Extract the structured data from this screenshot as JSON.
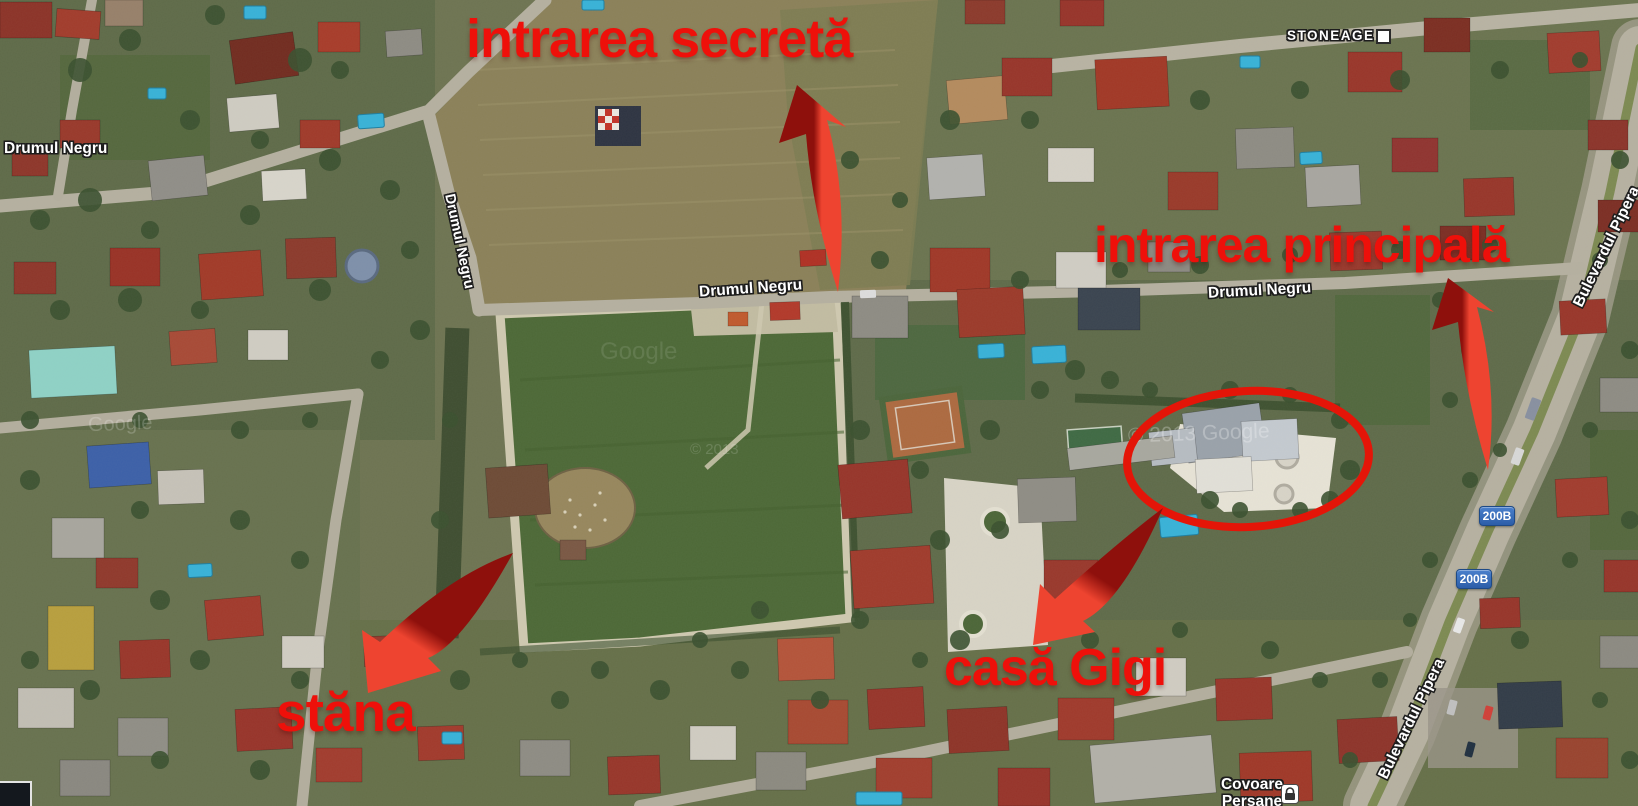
{
  "map": {
    "street_labels": {
      "drumul_negru": "Drumul Negru",
      "bulevardul_pipera": "Bulevardul Pipera",
      "stoneage": "STONEAGE"
    },
    "road_badge": {
      "route": "200B"
    },
    "poi": {
      "covoare_line1": "Covoare",
      "covoare_line2": "Persane"
    },
    "watermarks": {
      "google": "Google",
      "copyright_full": "© 2013 Google",
      "copyright_short": "© 2013"
    }
  },
  "annotations": {
    "secret_entrance": "intrarea secretă",
    "main_entrance": "intrarea principală",
    "gigi_house": "casă Gigi",
    "sheepfold": "stăna"
  },
  "colors": {
    "annotation_red": "#ee100a",
    "arrow_dark": "#8e100c",
    "arrow_bright": "#ee4430",
    "ellipse_red": "#e41508",
    "badge_blue": "#4a80cc",
    "label_white": "#ffffff"
  }
}
